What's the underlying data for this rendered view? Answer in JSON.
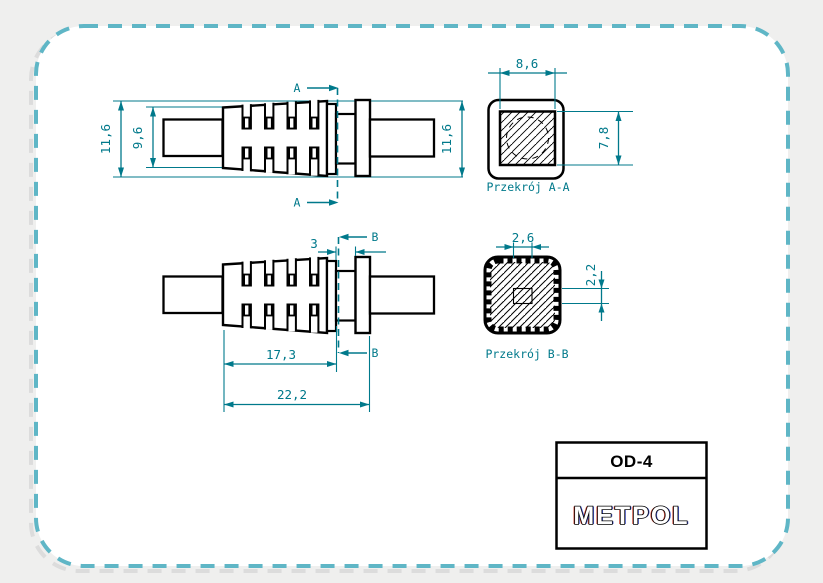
{
  "colors": {
    "dimension_teal": "#00798b",
    "frame_dash": "#5fb6c6",
    "frame_shadow": "#dcdcdc",
    "background": "#efefee",
    "drawing_line": "#000000",
    "logo_red_fringe": "#cc4433",
    "logo_blue_fringe": "#4455cc"
  },
  "front_view": {
    "dim_overall_height": "11,6",
    "dim_body_height": "9,6",
    "dim_right_height": "11,6",
    "cut_label": "A"
  },
  "side_view": {
    "dim_groove_width": "3",
    "dim_body_length": "17,3",
    "dim_total_length": "22,2",
    "cut_label": "B"
  },
  "section_aa": {
    "caption": "Przekrój A-A",
    "dim_width": "8,6",
    "dim_height": "7,8"
  },
  "section_bb": {
    "caption": "Przekrój B-B",
    "dim_width": "2,6",
    "dim_height": "2,2"
  },
  "title_block": {
    "part_number": "OD-4",
    "manufacturer": "METPOL"
  }
}
